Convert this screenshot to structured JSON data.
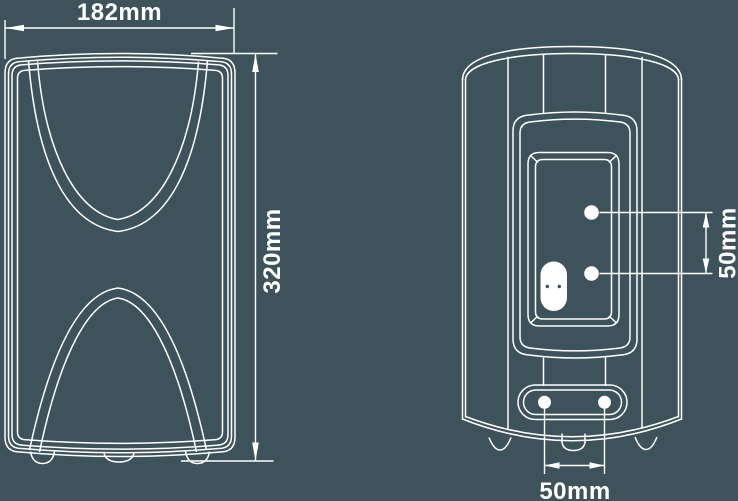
{
  "colors": {
    "background": "#3D525A",
    "line": "#FFFFFF"
  },
  "dimensions": {
    "front_width": {
      "label": "182mm"
    },
    "front_height": {
      "label": "320mm"
    },
    "rear_keyhole_spacing": {
      "label": "50mm"
    },
    "rear_bracket_hole_spacing": {
      "label": "50mm"
    }
  }
}
